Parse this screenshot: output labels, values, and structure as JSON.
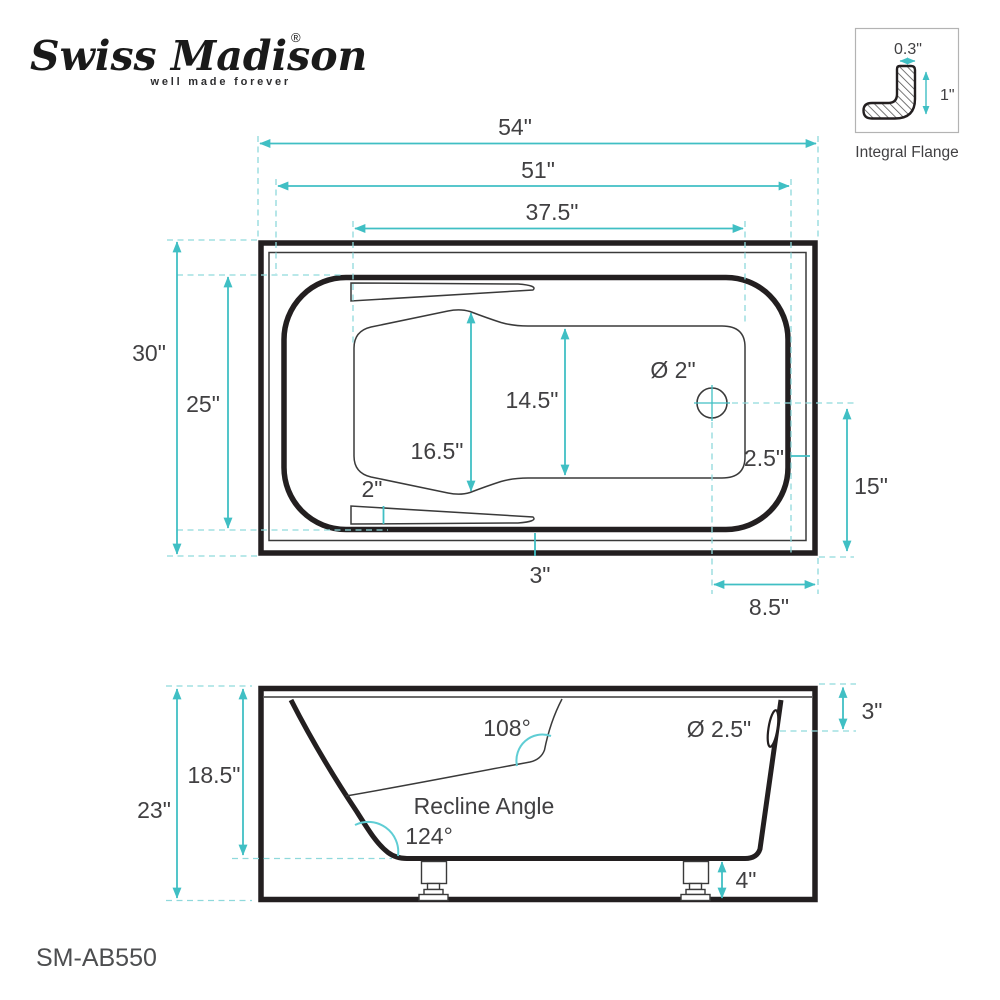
{
  "brand": {
    "name": "Swiss Madison",
    "registered": "®",
    "tagline": "well made forever"
  },
  "model_number": "SM-AB550",
  "colors": {
    "accent": "#40bfc4",
    "accent_dashed": "#8fd9dc",
    "line": "#231f20",
    "text": "#414042"
  },
  "flange_detail": {
    "label": "Integral Flange",
    "thickness": "0.3\"",
    "height": "1\""
  },
  "top_view": {
    "overall_length": "54\"",
    "basin_length": "51\"",
    "floor_length": "37.5\"",
    "overall_width": "30\"",
    "basin_width": "25\"",
    "backrest_width": "16.5\"",
    "floor_width": "14.5\"",
    "drain_diameter": "Ø 2\"",
    "armrest_width": "2\"",
    "rim_gap": "2.5\"",
    "drain_to_side": "15\"",
    "apron_gap": "3\"",
    "drain_to_end": "8.5\""
  },
  "side_view": {
    "recline_label": "Recline Angle",
    "recline_angle": "124°",
    "foot_angle": "108°",
    "basin_depth": "18.5\"",
    "overall_height": "23\"",
    "overflow_diameter": "Ø 2.5\"",
    "rim_to_overflow": "3\"",
    "leg_height": "4\""
  }
}
